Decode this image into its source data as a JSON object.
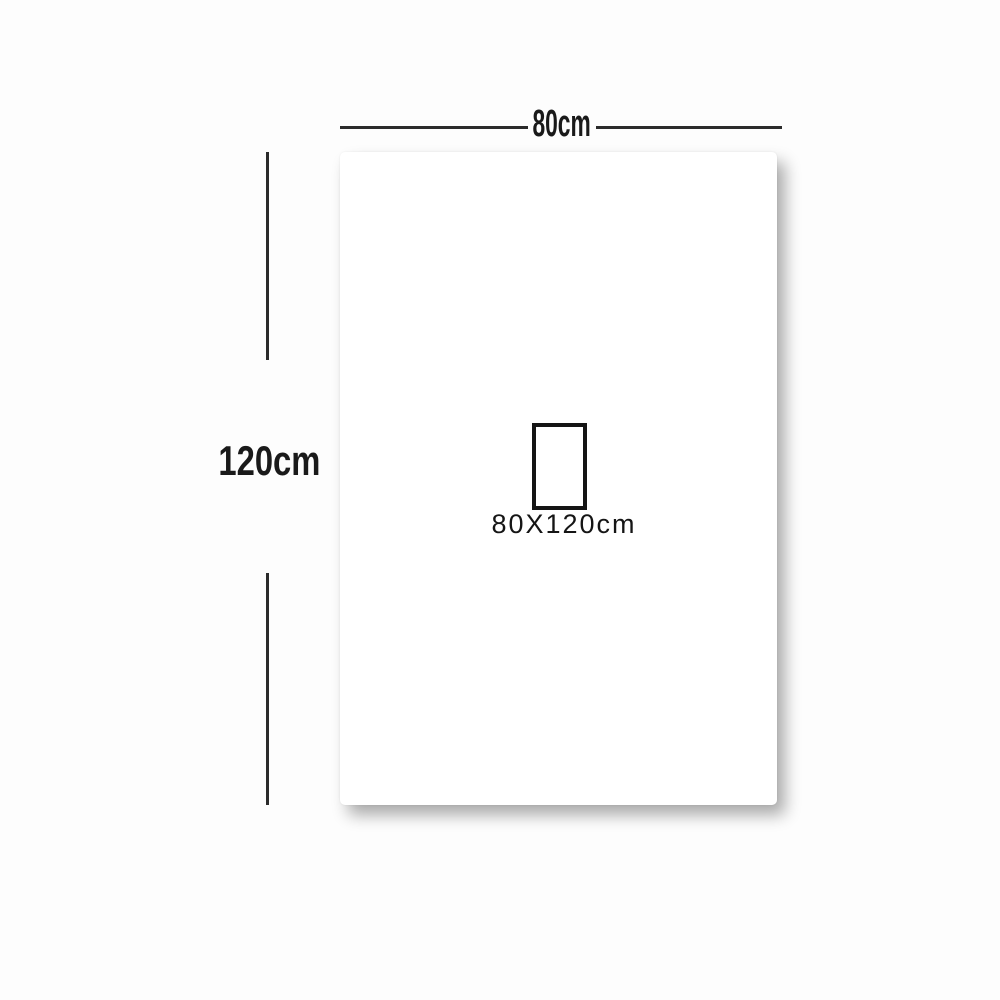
{
  "page": {
    "background_color": "#fdfdfd"
  },
  "diagram": {
    "type": "product-dimension-diagram",
    "sheet_color": "#ffffff",
    "line_color": "#2b2b2b",
    "text_color": "#1a1a1a",
    "width_dimension": {
      "label": "80cm"
    },
    "height_dimension": {
      "label": "120cm"
    },
    "size_box": {
      "label": "80X120cm"
    }
  }
}
